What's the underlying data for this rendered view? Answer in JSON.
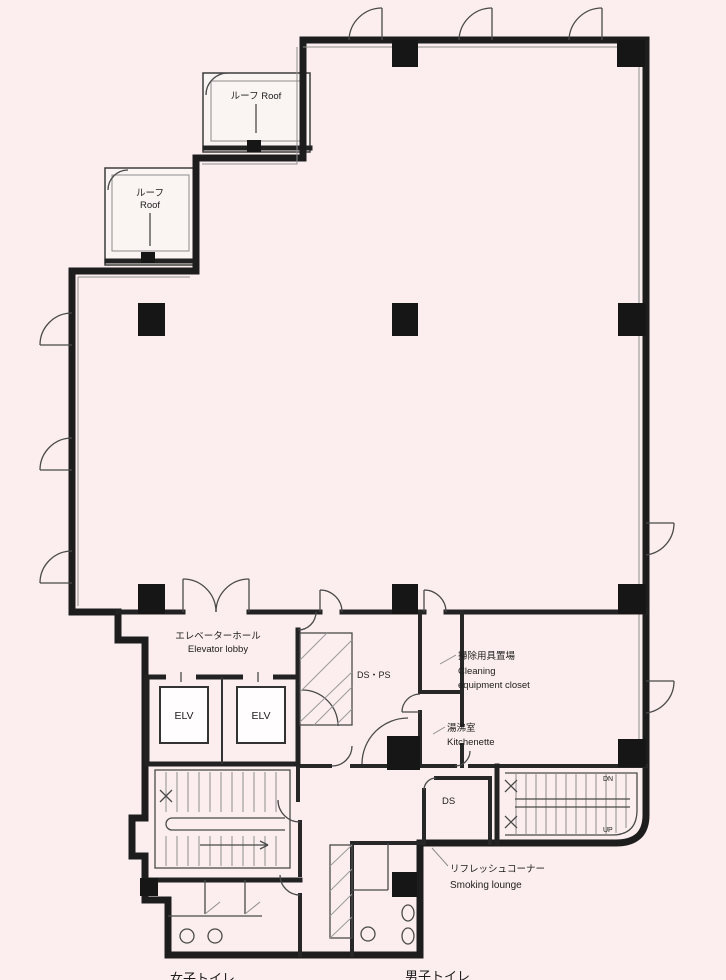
{
  "title": "office-building-floor-plan",
  "colors": {
    "background": "#fceeee",
    "wall": "#1d1d1d",
    "line": "#4a4a4a",
    "text": "#1c1c1c"
  },
  "labels": {
    "roof_upper": "ルーフ Roof",
    "roof_lower_ja": "ルーフ",
    "roof_lower_en": "Roof",
    "elevator_lobby_ja": "エレベーターホール",
    "elevator_lobby_en": "Elevator lobby",
    "elv_left": "ELV",
    "elv_right": "ELV",
    "ds_ps": "DS・PS",
    "cleaning_ja": "掃除用具置場",
    "cleaning_en_1": "Cleaning",
    "cleaning_en_2": "equipment closet",
    "kitchenette_ja": "湯沸室",
    "kitchenette_en": "Kitchenette",
    "ds": "DS",
    "stair_dn": "DN",
    "stair_up": "UP",
    "smoking_ja": "リフレッシュコーナー",
    "smoking_en": "Smoking lounge",
    "toilet_women": "女子トイレ",
    "toilet_men": "男子トイレ"
  }
}
